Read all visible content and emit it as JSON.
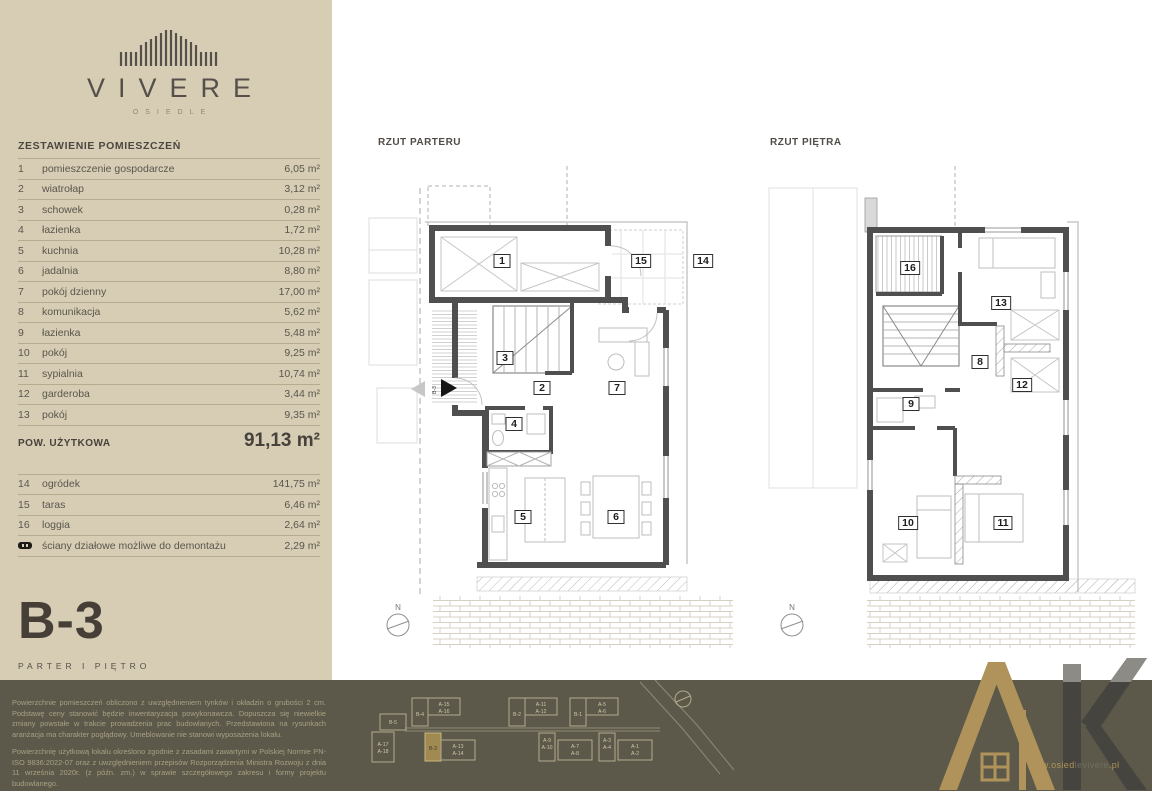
{
  "brand": {
    "name": "VIVERE",
    "subtitle": "OSIEDLE"
  },
  "sidebar": {
    "table_title": "ZESTAWIENIE POMIESZCZEŃ",
    "rooms": [
      {
        "no": "1",
        "name": "pomieszczenie gospodarcze",
        "area": "6,05 m²"
      },
      {
        "no": "2",
        "name": "wiatrołap",
        "area": "3,12 m²"
      },
      {
        "no": "3",
        "name": "schowek",
        "area": "0,28 m²"
      },
      {
        "no": "4",
        "name": "łazienka",
        "area": "1,72 m²"
      },
      {
        "no": "5",
        "name": "kuchnia",
        "area": "10,28 m²"
      },
      {
        "no": "6",
        "name": "jadalnia",
        "area": "8,80 m²"
      },
      {
        "no": "7",
        "name": "pokój dzienny",
        "area": "17,00 m²"
      },
      {
        "no": "8",
        "name": "komunikacja",
        "area": "5,62 m²"
      },
      {
        "no": "9",
        "name": "łazienka",
        "area": "5,48 m²"
      },
      {
        "no": "10",
        "name": "pokój",
        "area": "9,25 m²"
      },
      {
        "no": "11",
        "name": "sypialnia",
        "area": "10,74 m²"
      },
      {
        "no": "12",
        "name": "garderoba",
        "area": "3,44 m²"
      },
      {
        "no": "13",
        "name": "pokój",
        "area": "9,35 m²"
      }
    ],
    "total": {
      "label": "POW. UŻYTKOWA",
      "value": "91,13 m²"
    },
    "extras": [
      {
        "no": "14",
        "name": "ogródek",
        "area": "141,75 m²"
      },
      {
        "no": "15",
        "name": "taras",
        "area": "6,46 m²"
      },
      {
        "no": "16",
        "name": "loggia",
        "area": "2,64 m²"
      }
    ],
    "partition_note": {
      "name": "ściany działowe możliwe do demontażu",
      "area": "2,29 m²"
    },
    "unit": "B-3",
    "floors": "PARTER   I   PIĘTRO"
  },
  "plans": {
    "parter": {
      "title": "RZUT PARTERU",
      "compass": "N",
      "entrance_label": "B-3",
      "markers": [
        "1",
        "15",
        "14",
        "3",
        "2",
        "7",
        "4",
        "5",
        "6"
      ]
    },
    "pietro": {
      "title": "RZUT PIĘTRA",
      "compass": "N",
      "markers": [
        "16",
        "13",
        "8",
        "12",
        "9",
        "10",
        "11"
      ]
    }
  },
  "footer": {
    "para1": "Powierzchnie pomieszczeń obliczono z uwzględnieniem tynków i okładzin o grubości 2 cm. Podstawę ceny stanowić będzie inwentaryzacja powykonawcza. Dopuszcza się niewielkie zmiany powstałe w trakcie prowadzenia prac budowlanych. Przedstawiona na rysunkach aranżacja ma charakter poglądowy. Umeblowanie nie stanowi wyposażenia lokalu.",
    "para2": "Powierzchnię użytkową lokalu określono zgodnie z zasadami zawartymi w Polskiej Normie PN-ISO 9836:2022-07 oraz z uwzględnieniem przepisów Rozporządzenia Ministra Rozwoju z dnia 11 września 2020r. (z późn. zm.) w sprawie szczegółowego zakresu i formy projektu budowlanego.",
    "site": {
      "b5": "B-5",
      "a17": "A-17",
      "a18": "A-18",
      "b4": "B-4",
      "a15": "A-15",
      "a16": "A-16",
      "b2": "B-2",
      "a11": "A-11",
      "a12": "A-12",
      "b1": "B-1",
      "a5": "A-5",
      "a6": "A-6",
      "b3": "B-3",
      "a13": "A-13",
      "a14": "A-14",
      "a9": "A-9",
      "a10": "A-10",
      "a7": "A-7",
      "a8": "A-8",
      "a3": "A-3",
      "a4": "A-4",
      "a1": "A-1",
      "a2": "A-2",
      "highlighted": "B-3"
    },
    "website": {
      "prefix": "www.osied",
      "mid": "levivere",
      "suffix": ".pl"
    }
  },
  "colors": {
    "sidebar_bg": "#d6cdb4",
    "band_bg": "#5c594a",
    "gold": "#b0935a",
    "text": "#55504a",
    "wall": "#4f4f4f",
    "line": "#b5ab8f"
  }
}
